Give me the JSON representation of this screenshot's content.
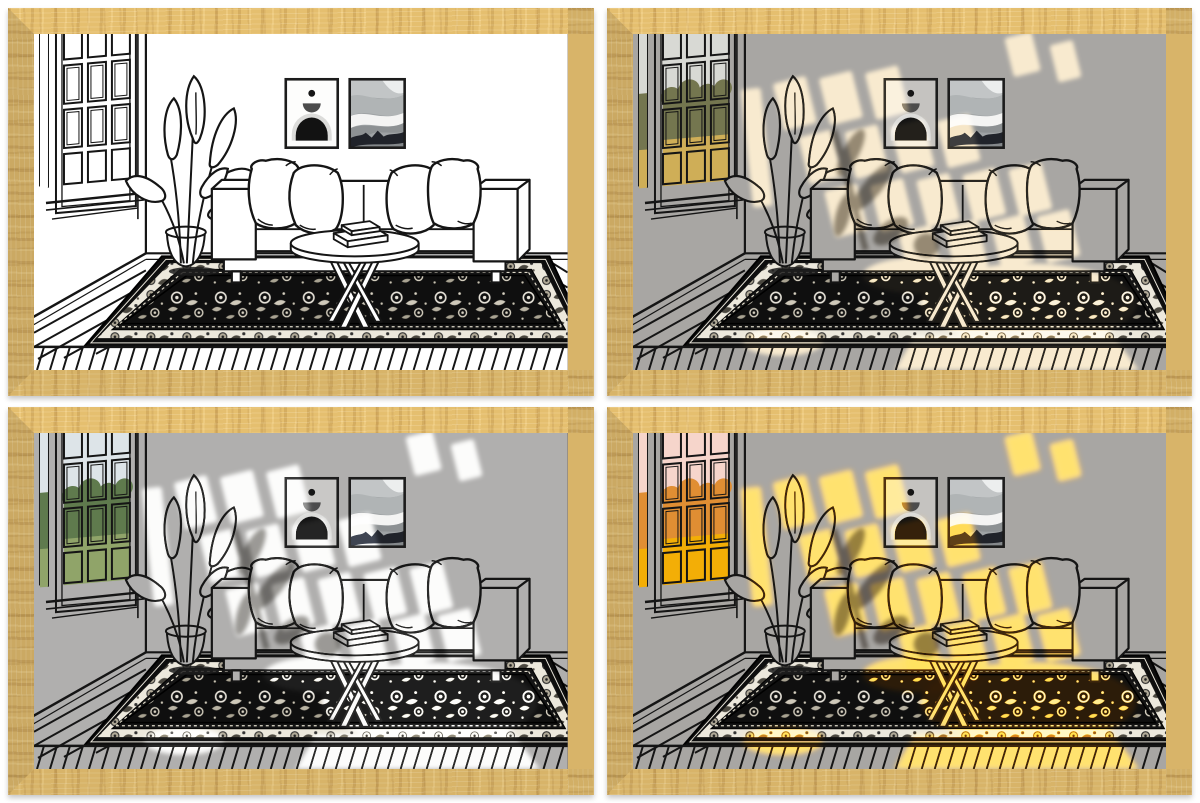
{
  "artwork": {
    "description": "2x2 collage of a framed line-art living room illustration shown with four lighting effects",
    "frame": {
      "wood_color": "#d8b469",
      "gap_background": "#ffffff"
    },
    "scene_elements": [
      "window",
      "potted-plant",
      "sofa",
      "pillows",
      "wall-art-arch",
      "wall-art-waves",
      "coffee-table",
      "books",
      "oriental-rug",
      "wood-plank-floor"
    ]
  },
  "panels": [
    {
      "id": "top-left",
      "variant": "plain-line-art",
      "background": "#ffffff",
      "poster": "#fdfdfc",
      "sun": "transparent",
      "sun2": "transparent",
      "shadow": "transparent",
      "sky": "#ffffff",
      "tree": "#ffffff",
      "grass": "#ffffff"
    },
    {
      "id": "top-right",
      "variant": "warm-afternoon-light",
      "background": "#a8a6a3",
      "poster": "#c5c3c0",
      "sun": "#f6e2bd",
      "sun2": "transparent",
      "shadow": "#9a958d",
      "sky": "#d8d9d4",
      "tree": "#74764f",
      "grass": "#cfae57"
    },
    {
      "id": "bottom-left",
      "variant": "cool-daylight",
      "background": "#b0afae",
      "poster": "#c9c8c6",
      "sun": "#fbfbf9",
      "sun2": "transparent",
      "shadow": "#9d9b98",
      "sky": "#dde4e8",
      "tree": "#5f7a4d",
      "grass": "#90a469"
    },
    {
      "id": "bottom-right",
      "variant": "golden-sunset-light",
      "background": "#a8a6a3",
      "poster": "#c5c3c0",
      "sun": "#ffd26e",
      "sun2": "rgba(248,152,38,0.5)",
      "shadow": "#97908a",
      "sky": "#f6d5cb",
      "tree": "#e08e33",
      "grass": "#f3ae06"
    }
  ]
}
